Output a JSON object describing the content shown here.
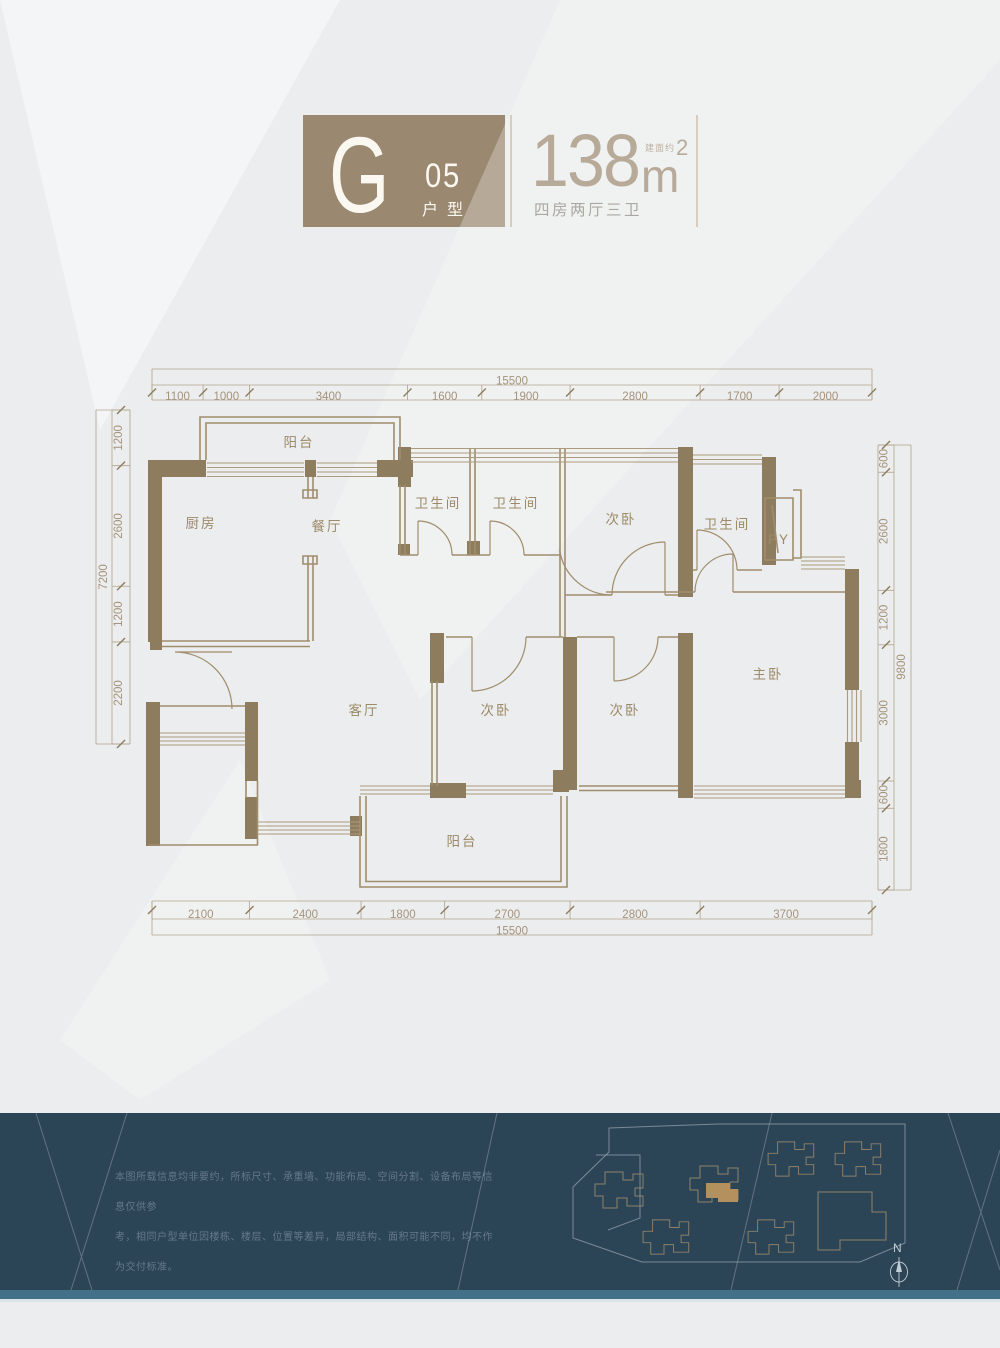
{
  "header": {
    "type_letter": "G",
    "type_number": "05",
    "type_label": "户型",
    "area_value": "138",
    "area_prefix": "建面约",
    "area_unit": "m",
    "area_sup": "2",
    "layout_desc": "四房两厅三卫"
  },
  "floorplan": {
    "rooms": [
      {
        "name": "balcony-north",
        "label": "阳台",
        "x": 299,
        "y": 447
      },
      {
        "name": "kitchen",
        "label": "厨房",
        "x": 201,
        "y": 528
      },
      {
        "name": "dining-room",
        "label": "餐厅",
        "x": 327,
        "y": 531
      },
      {
        "name": "bathroom-1",
        "label": "卫生间",
        "x": 438,
        "y": 508,
        "size": 12
      },
      {
        "name": "bathroom-2",
        "label": "卫生间",
        "x": 516,
        "y": 508,
        "size": 12
      },
      {
        "name": "bedroom-north",
        "label": "次卧",
        "x": 621,
        "y": 524
      },
      {
        "name": "bathroom-3",
        "label": "卫生间",
        "x": 727,
        "y": 529,
        "size": 12
      },
      {
        "name": "py-shaft",
        "label": "PY",
        "x": 779,
        "y": 544,
        "size": 11
      },
      {
        "name": "master-bedroom",
        "label": "主卧",
        "x": 768,
        "y": 679
      },
      {
        "name": "living-room",
        "label": "客厅",
        "x": 364,
        "y": 715
      },
      {
        "name": "bedroom-2",
        "label": "次卧",
        "x": 496,
        "y": 715
      },
      {
        "name": "bedroom-3",
        "label": "次卧",
        "x": 625,
        "y": 715
      },
      {
        "name": "balcony-south",
        "label": "阳台",
        "x": 462,
        "y": 846
      }
    ],
    "dimensions": {
      "top": {
        "total": "15500",
        "segments": [
          "1100",
          "1000",
          "3400",
          "1600",
          "1900",
          "2800",
          "1700",
          "2000"
        ]
      },
      "bottom": {
        "total": "15500",
        "segments": [
          "2100",
          "2400",
          "1800",
          "2700",
          "2800",
          "3700"
        ]
      },
      "left": {
        "total": "7200",
        "segments": [
          "1200",
          "2600",
          "1200",
          "2200"
        ]
      },
      "right": {
        "total": "9800",
        "segments": [
          "600",
          "2600",
          "1200",
          "3000",
          "600",
          "1800"
        ]
      }
    }
  },
  "footer": {
    "disclaimer_lines": [
      "本图所载信息均非要约，所标尺寸、承重墙、功能布局、空间分割、设备布局等信息仅供参",
      "考，相同户型单位因楼栋、楼层、位置等差异，局部结构、面积可能不同，均不作为交付标准。",
      "具体建筑构建及交付面积以政府最后批准之法律文件及买卖合同约定为准。"
    ],
    "compass_label": "N"
  },
  "colors": {
    "accent_tan": "#9a8871",
    "wall": "#8d7c5e",
    "dim_text": "#a5937c",
    "footer_bg": "#2b4557",
    "footer_strip": "#45708a",
    "highlight_building": "#b5905f",
    "background": "#ebedee"
  }
}
